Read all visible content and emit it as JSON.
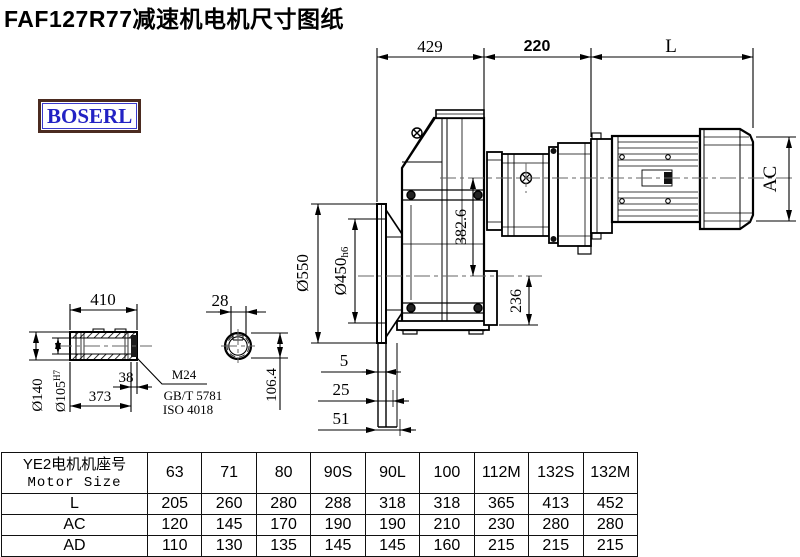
{
  "title": "FAF127R77减速机电机尺寸图纸",
  "logo_text": "BOSERL",
  "colors": {
    "line": "#000000",
    "logo_text": "#2222c4",
    "logo_border": "#4b2b20",
    "centerline": "#666666"
  },
  "dims": {
    "top_left": "429",
    "top_mid": "220",
    "top_right": "L",
    "ac": "AC",
    "dia550": "Ø550",
    "dia450": "Ø450",
    "dia450_tol": "h6",
    "height382": "382.6",
    "height236": "236",
    "off5": "5",
    "off25": "25",
    "off51": "51",
    "shaft_len": "410",
    "shaft38": "38",
    "shaft373": "373",
    "dia140": "Ø140",
    "dia105": "Ø105",
    "dia105_tol": "H7",
    "thread": "M24",
    "std1": "GB/T 5781",
    "std2": "ISO 4018",
    "key_w": "28",
    "key_h": "106.4"
  },
  "table": {
    "header_cn": "YE2电机机座号",
    "header_en": "Motor Size",
    "columns": [
      "63",
      "71",
      "80",
      "90S",
      "90L",
      "100",
      "112M",
      "132S",
      "132M"
    ],
    "rows": [
      {
        "label": "L",
        "values": [
          "205",
          "260",
          "280",
          "288",
          "318",
          "318",
          "365",
          "413",
          "452"
        ]
      },
      {
        "label": "AC",
        "values": [
          "120",
          "145",
          "170",
          "190",
          "190",
          "210",
          "230",
          "280",
          "280"
        ]
      },
      {
        "label": "AD",
        "values": [
          "110",
          "130",
          "135",
          "145",
          "145",
          "160",
          "215",
          "215",
          "215"
        ]
      }
    ]
  }
}
